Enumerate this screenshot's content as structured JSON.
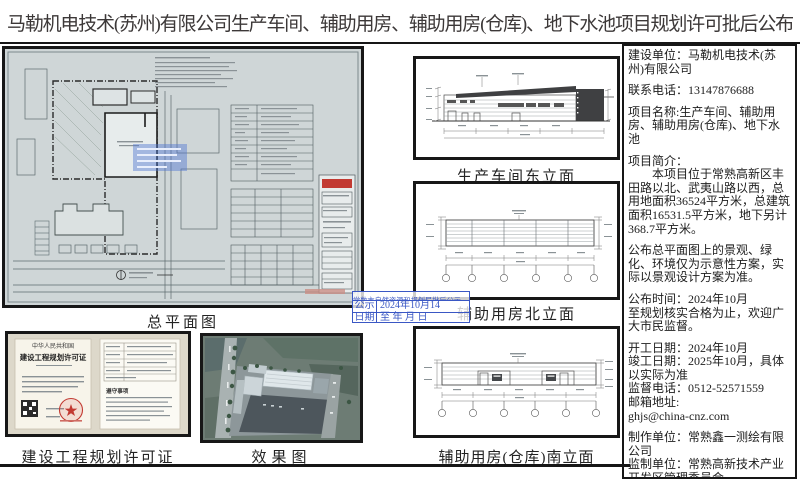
{
  "title": "马勒机电技术(苏州)有限公司生产车间、辅助用房、辅助用房(仓库)、地下水池项目规划许可批后公布",
  "captions": {
    "site_plan": "总平面图",
    "permit": "建设工程规划许可证",
    "render": "效果图",
    "elev_east": "生产车间东立面",
    "elev_north": "辅助用房北立面",
    "elev_south": "辅助用房(仓库)南立面"
  },
  "permit_doc": {
    "country": "中华人民共和国",
    "doc_title": "建设工程规划许可证",
    "notes_heading": "遵守事项"
  },
  "stamp": {
    "header": "常熟市自然资源和规划局批后公示",
    "row1_label": "公示",
    "row2_label": "日期",
    "row1_value": "2024年10月14",
    "row2_value": "至    年   月   日"
  },
  "info": {
    "paragraphs": [
      "建设单位：马勒机电技术(苏州)有限公司",
      "联系电话：13147876688",
      "项目名称:生产车间、辅助用房、辅助用房(仓库)、地下水池",
      "项目简介：\n　　本项目位于常熟高新区丰田路以北、武夷山路以西，总用地面积36524平方米，总建筑面积16531.5平方米，地下另计368.7平方米。",
      "公布总平面图上的景观、绿化、环境仅为示意性方案，实际以景观设计方案为准。",
      "公布时间：2024年10月\n至规划核实合格为止，欢迎广大市民监督。",
      "开工日期：2024年10月\n竣工日期：2025年10月，具体以实际为准\n监督电话：0512-52571559\n邮箱地址:\nghjs@china-cnz.com",
      "制作单位：常熟鑫一测绘有限公司\n监制单位：常熟高新技术产业开发区管理委员会"
    ]
  },
  "colors": {
    "stamp_blue": "#3a57c4",
    "border_black": "#171717",
    "plan_paper": "#cfd6d7",
    "seal_red": "#c23a32",
    "highlight_blue": "rgba(80,120,210,0.45)"
  }
}
